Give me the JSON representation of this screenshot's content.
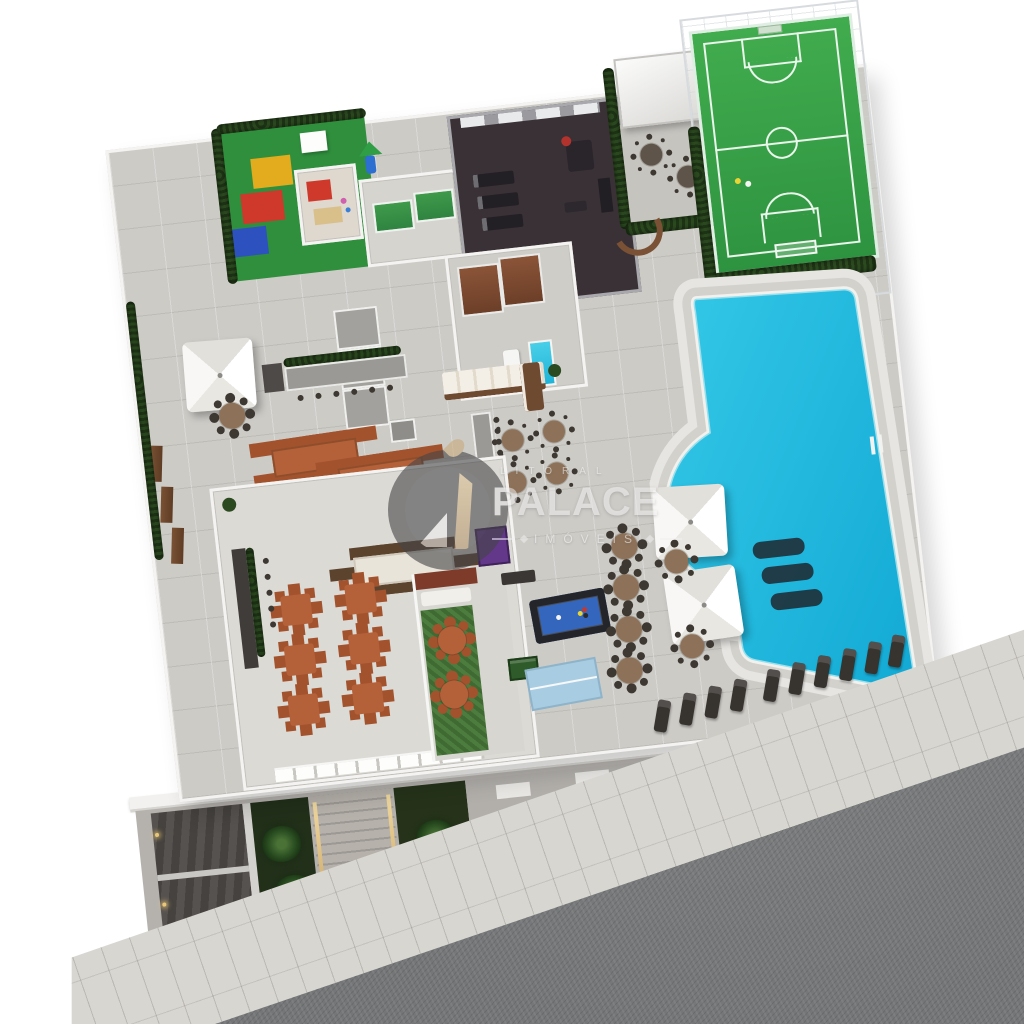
{
  "watermark": {
    "brand_top": "LITORAL",
    "brand_main": "PALACE",
    "brand_sub": "IMÓVEIS"
  },
  "palette": {
    "deck": "#cdcbc6",
    "wall": "#f4f3f1",
    "sidewalk": "#d8d6d1",
    "street": "#747678",
    "pool-water-1": "#35c9e8",
    "pool-water-2": "#12a9d4",
    "pool-coping": "#f2f1ee",
    "court-green-1": "#41ac4e",
    "court-green-2": "#2e9340",
    "court-line": "#eaf5ec",
    "hedge-1": "#2c4a20",
    "hedge-2": "#1e3415",
    "garden-dark": "#22301a",
    "playground-green": "#2f8f3d",
    "mat-yellow": "#e2ac1e",
    "mat-red": "#cf392b",
    "mat-blue": "#2d52c0",
    "gym-floor": "#3a3136",
    "gym-wall": "#a9a9ad",
    "terracotta": "#b4613a",
    "terracotta-dark": "#a2522d",
    "wood": "#7a5134",
    "chair-dark": "#3e3833",
    "sauna": "#7c4a32",
    "red-wall": "#7e3b2a",
    "billiard-felt": "#3466bd",
    "pingpong": "#a8cde2",
    "ramp": "#4c4947",
    "facade": "#b5b2ae",
    "light-warm": "#e8c878",
    "logo-ring": "#454547",
    "logo-gold": "#c5a678",
    "watermark-text": "#f0f0f0"
  },
  "regions": [
    {
      "name": "kids-playground"
    },
    {
      "name": "kids-playroom"
    },
    {
      "name": "kids-games-room"
    },
    {
      "name": "fitness-gym"
    },
    {
      "name": "covered-pergola-lounge"
    },
    {
      "name": "multisport-court"
    },
    {
      "name": "hedge-garden"
    },
    {
      "name": "swimming-pool"
    },
    {
      "name": "pool-sun-ledge-loungers"
    },
    {
      "name": "pool-umbrella-tables"
    },
    {
      "name": "sun-lounger-row"
    },
    {
      "name": "spa-sauna"
    },
    {
      "name": "plunge-pool"
    },
    {
      "name": "outdoor-lounge-sofa"
    },
    {
      "name": "pool-bar-counter"
    },
    {
      "name": "round-dining-tables"
    },
    {
      "name": "gourmet-barbecue"
    },
    {
      "name": "service-core"
    },
    {
      "name": "shade-umbrella-terrace"
    },
    {
      "name": "garden-benches"
    },
    {
      "name": "outdoor-dining-tables"
    },
    {
      "name": "party-hall"
    },
    {
      "name": "party-hall-kitchen"
    },
    {
      "name": "winter-garden"
    },
    {
      "name": "billiards-table"
    },
    {
      "name": "table-tennis"
    },
    {
      "name": "foosball-table"
    },
    {
      "name": "garage-ramp"
    },
    {
      "name": "entry-stairs"
    },
    {
      "name": "street-gardens"
    },
    {
      "name": "sidewalk"
    },
    {
      "name": "street"
    }
  ]
}
